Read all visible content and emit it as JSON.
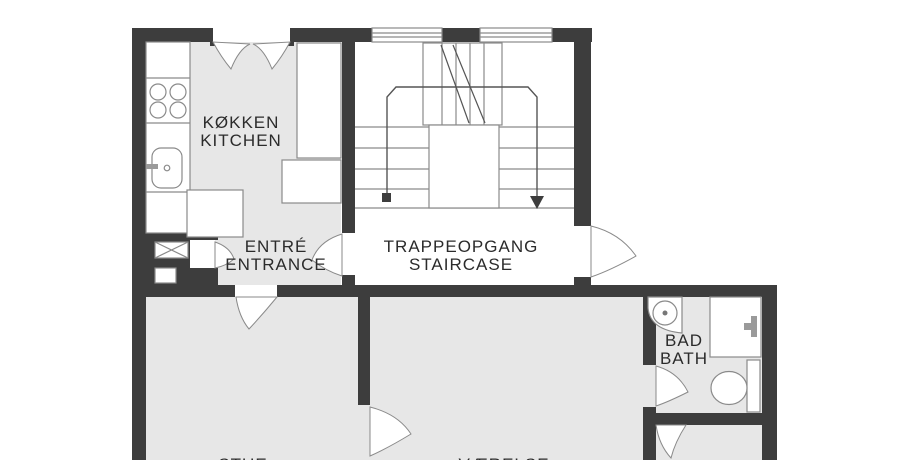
{
  "title": "Apartment floor plan",
  "colors": {
    "bg": "#ffffff",
    "wall": "#3d3d3d",
    "floor": "#e7e7e7",
    "line": "#8a8a8a",
    "fixture": "#9a9a9a",
    "text": "#2b2b2b"
  },
  "rooms": {
    "kitchen": {
      "label_da": "KØKKEN",
      "label_en": "KITCHEN"
    },
    "entrance": {
      "label_da": "ENTRÉ",
      "label_en": "ENTRANCE"
    },
    "staircase": {
      "label_da": "TRAPPEOPGANG",
      "label_en": "STAIRCASE"
    },
    "bath": {
      "label_da": "BAD",
      "label_en": "BATH"
    },
    "living": {
      "label_da": "STUE"
    },
    "bedroom": {
      "label_da": "VÆRELSE"
    }
  }
}
